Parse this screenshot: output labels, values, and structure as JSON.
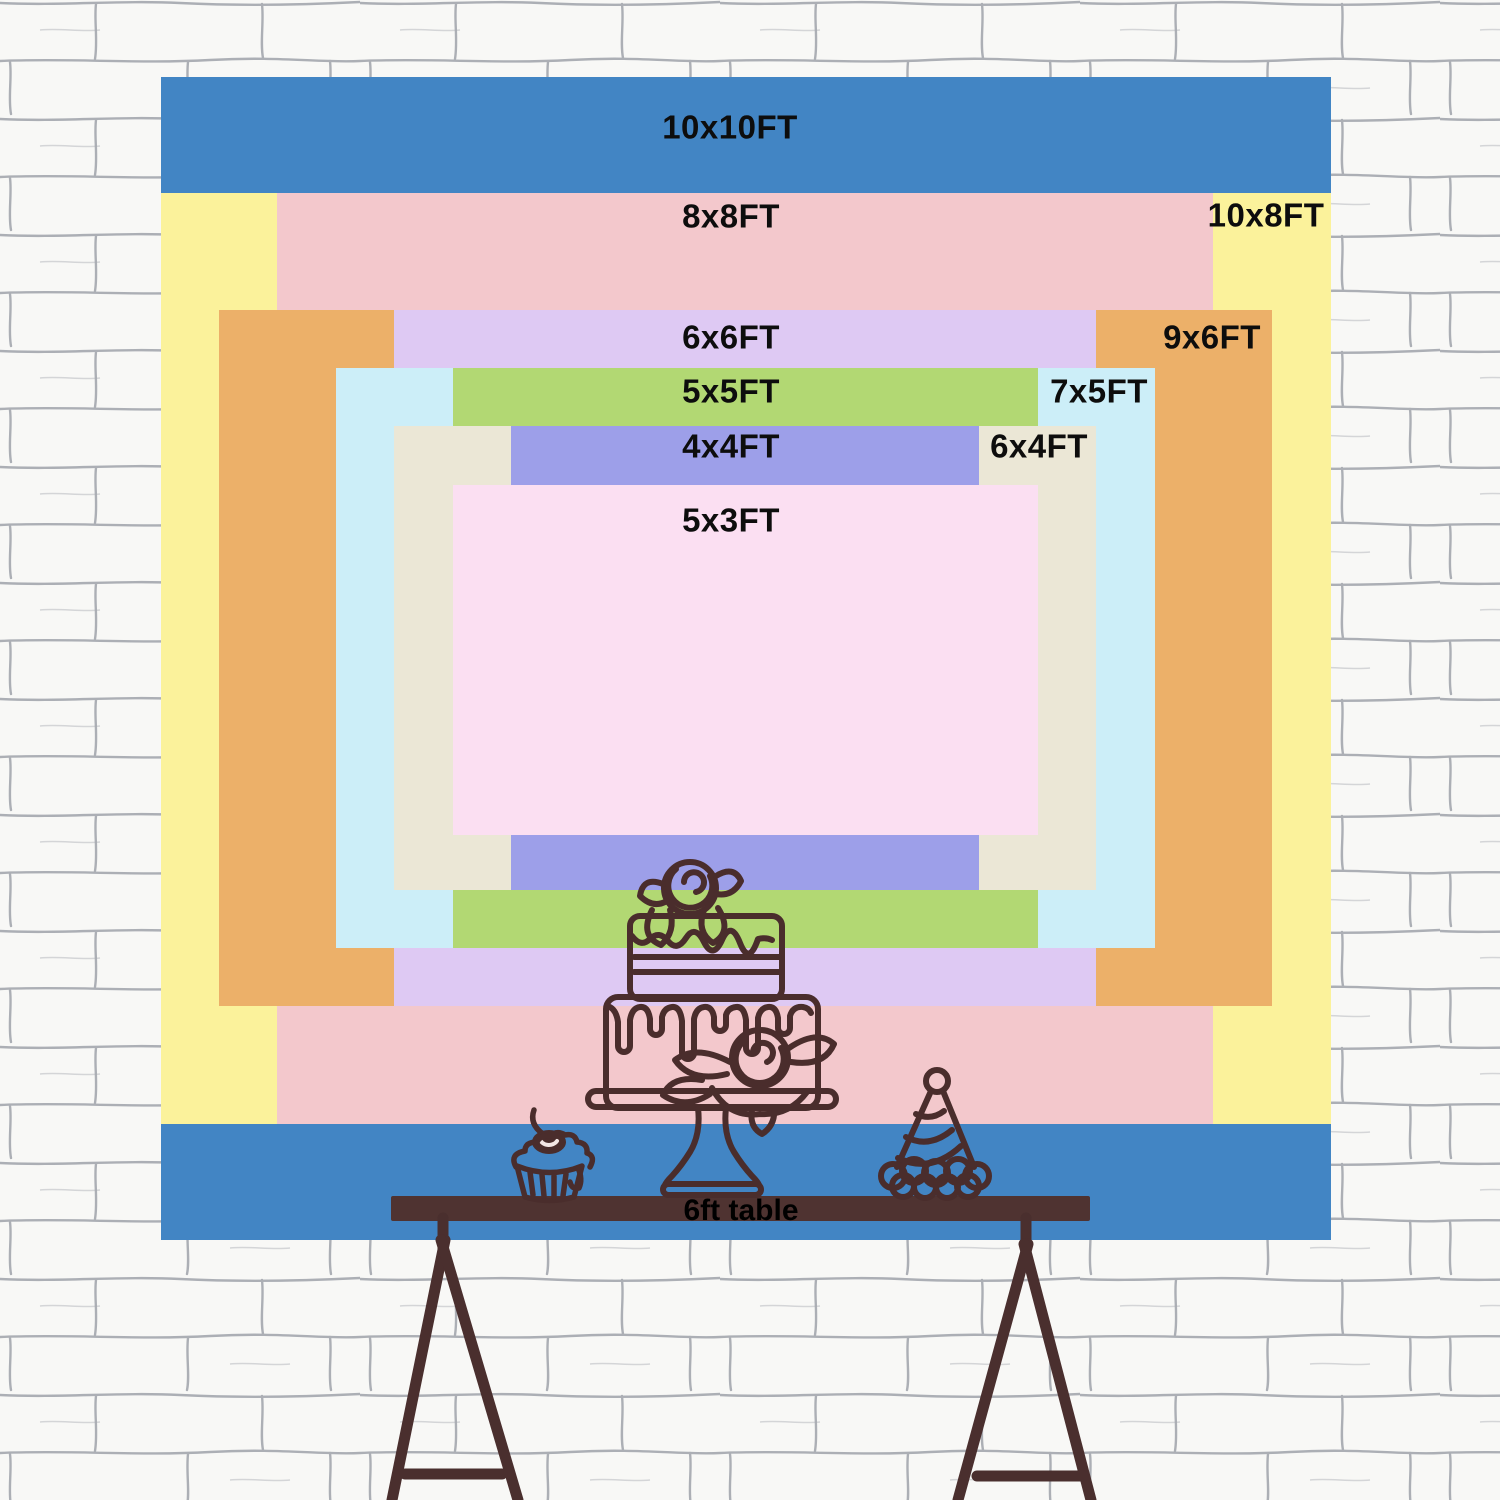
{
  "backdrop": {
    "unit": "FT",
    "sizes": [
      {
        "id": "10x10ft",
        "label": "10x10FT",
        "width_ft": 10,
        "height_ft": 10,
        "color": "#4285c4",
        "rect": {
          "x": 161,
          "y": 77,
          "w": 1170,
          "h": 1163
        },
        "label_pos": {
          "x": 730,
          "y": 127
        }
      },
      {
        "id": "10x8ft",
        "label": "10x8FT",
        "width_ft": 10,
        "height_ft": 8,
        "color": "#fbf29b",
        "rect": {
          "x": 161,
          "y": 193,
          "w": 1170,
          "h": 931
        },
        "label_pos": {
          "x": 1266,
          "y": 215
        }
      },
      {
        "id": "8x8ft",
        "label": "8x8FT",
        "width_ft": 8,
        "height_ft": 8,
        "color": "#f3c8cc",
        "rect": {
          "x": 277,
          "y": 193,
          "w": 936,
          "h": 931
        },
        "label_pos": {
          "x": 731,
          "y": 216
        }
      },
      {
        "id": "9x6ft",
        "label": "9x6FT",
        "width_ft": 9,
        "height_ft": 6,
        "color": "#ecb069",
        "rect": {
          "x": 219,
          "y": 310,
          "w": 1053,
          "h": 696
        },
        "label_pos": {
          "x": 1212,
          "y": 337
        }
      },
      {
        "id": "6x6ft",
        "label": "6x6FT",
        "width_ft": 6,
        "height_ft": 6,
        "color": "#dec9f3",
        "rect": {
          "x": 394,
          "y": 310,
          "w": 702,
          "h": 696
        },
        "label_pos": {
          "x": 731,
          "y": 337
        }
      },
      {
        "id": "7x5ft",
        "label": "7x5FT",
        "width_ft": 7,
        "height_ft": 5,
        "color": "#cceef8",
        "rect": {
          "x": 336,
          "y": 368,
          "w": 819,
          "h": 580
        },
        "label_pos": {
          "x": 1099,
          "y": 391
        }
      },
      {
        "id": "5x5ft",
        "label": "5x5FT",
        "width_ft": 5,
        "height_ft": 5,
        "color": "#b2d873",
        "rect": {
          "x": 453,
          "y": 368,
          "w": 585,
          "h": 580
        },
        "label_pos": {
          "x": 731,
          "y": 391
        }
      },
      {
        "id": "6x4ft",
        "label": "6x4FT",
        "width_ft": 6,
        "height_ft": 4,
        "color": "#ebe7d6",
        "rect": {
          "x": 394,
          "y": 426,
          "w": 702,
          "h": 464
        },
        "label_pos": {
          "x": 1039,
          "y": 446
        }
      },
      {
        "id": "4x4ft",
        "label": "4x4FT",
        "width_ft": 4,
        "height_ft": 4,
        "color": "#9d9fe9",
        "rect": {
          "x": 511,
          "y": 426,
          "w": 468,
          "h": 464
        },
        "label_pos": {
          "x": 731,
          "y": 446
        }
      },
      {
        "id": "5x3ft",
        "label": "5x3FT",
        "width_ft": 5,
        "height_ft": 3,
        "color": "#fbdff2",
        "rect": {
          "x": 453,
          "y": 485,
          "w": 585,
          "h": 350
        },
        "label_pos": {
          "x": 731,
          "y": 520
        }
      }
    ]
  },
  "table": {
    "label": "6ft table",
    "length_ft": 6,
    "bar_color": "#4f3331",
    "label_pos": {
      "x": 741,
      "y": 1211
    }
  },
  "icons": {
    "cake": "tiered-cake-icon",
    "cupcake": "cupcake-icon",
    "party_hat": "party-hat-icon",
    "trestle_legs": "trestle-legs-icon"
  },
  "style_colors": {
    "line_art": "#4a2d2c",
    "wall_base": "#f8f8f6",
    "wall_mortar": "#8b909a",
    "label_text": "#0d0d0d"
  }
}
